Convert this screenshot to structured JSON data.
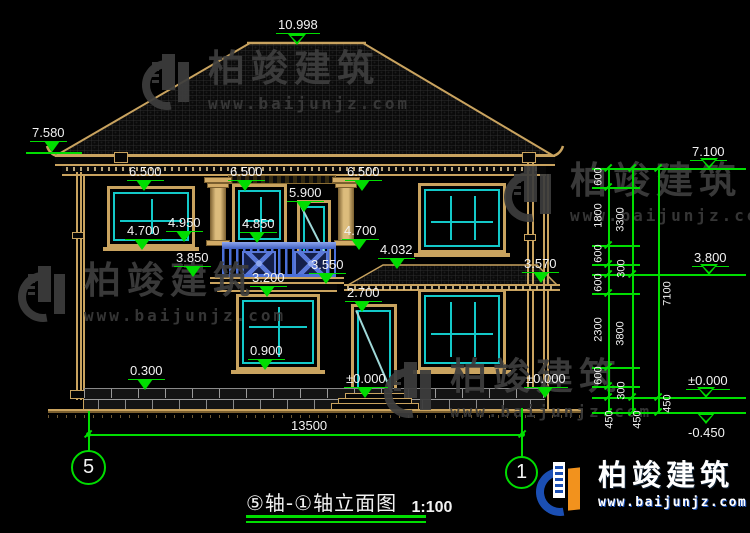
{
  "brand": {
    "name": "柏竣建筑",
    "url": "www.baijunjz.com"
  },
  "footer_logo": {
    "name": "柏竣建筑",
    "url": "www.baijunjz.com"
  },
  "title": {
    "main": "⑤轴-①轴立面图",
    "scale": "1:100"
  },
  "axis": {
    "left": "5",
    "right": "1"
  },
  "levels": {
    "ridge": "10.998",
    "eave_left": "7.580",
    "eave_right": "7.100",
    "mid_right": "3.800",
    "zero_right": "±0.000",
    "ground_right": "-0.450",
    "l6500_1": "6.500",
    "l6500_2": "6.500",
    "l6500_3": "6.500",
    "l5900": "5.900",
    "l4950": "4.950",
    "l4850": "4.850",
    "l4700_1": "4.700",
    "l4700_2": "4.700",
    "l4032": "4.032",
    "l3850": "3.850",
    "l3570": "3.570",
    "l3550": "3.550",
    "l3200": "3.200",
    "l2700": "2.700",
    "l0900": "0.900",
    "l0300": "0.300",
    "zero_door": "±0.000",
    "zero_wall": "±0.000"
  },
  "dims": {
    "total": "13500",
    "chain_a": [
      "600",
      "1800",
      "600",
      "300",
      "600",
      "2300",
      "600",
      "300",
      "450"
    ],
    "chain_b": [
      "3300",
      "3800",
      "450"
    ],
    "chain_c": [
      "7100",
      "450"
    ]
  },
  "colors": {
    "accent_green": "#00dd00",
    "outline_tan": "#c9a35f",
    "window_cyan": "#13c9c9",
    "railing_blue": "#4a6fd8",
    "logo_blue": "#1b4fb4"
  }
}
